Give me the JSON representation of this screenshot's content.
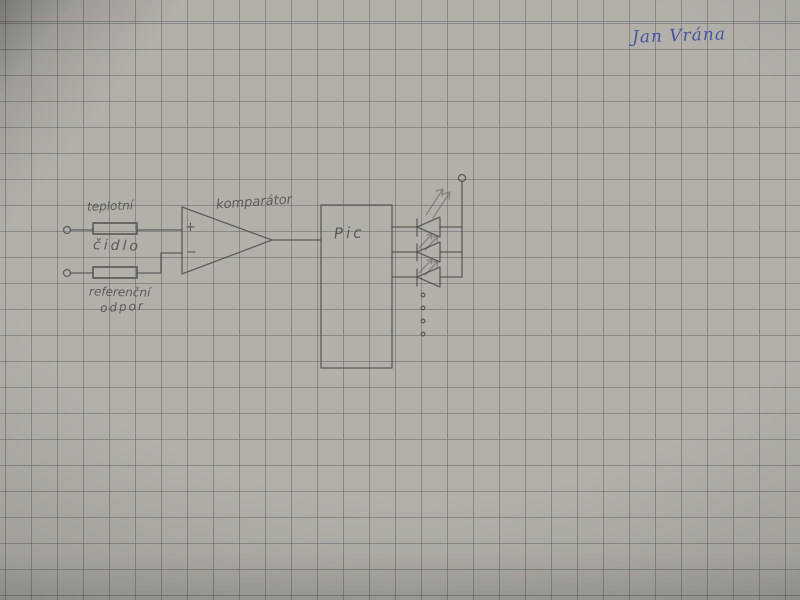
{
  "photo": {
    "description": "photograph of a hand-drawn electronic schematic in pencil on squared graph paper, signed in blue pen",
    "colors": {
      "paper": "#b2b0a9",
      "grid_line": "#84868a",
      "pencil": "#4e4c48",
      "pen_ink": "#4150a4"
    }
  },
  "signature": {
    "text": "Jan Vrána"
  },
  "labels": {
    "sensor_line1": "teplotní",
    "sensor_line2": "čidlo",
    "reference_line1": "referenční",
    "reference_line2": "odpor",
    "comparator": "komparátor",
    "mcu": "Pic",
    "plus_input": "+",
    "minus_input": "−"
  },
  "schematic": {
    "components": [
      {
        "name": "input-terminal-top",
        "symbol": "open circle"
      },
      {
        "name": "temperature-sensor-resistor",
        "symbol": "rectangle",
        "label": "teplotní čidlo"
      },
      {
        "name": "input-terminal-bottom",
        "symbol": "open circle"
      },
      {
        "name": "reference-resistor",
        "symbol": "rectangle",
        "label": "referenční odpor"
      },
      {
        "name": "comparator",
        "symbol": "op-amp triangle",
        "inputs": [
          "+",
          "−"
        ],
        "label": "komparátor"
      },
      {
        "name": "microcontroller",
        "symbol": "rectangle",
        "label": "Pic"
      },
      {
        "name": "led-array",
        "symbol": "LED triangles with emission arrows",
        "led_count": 3
      },
      {
        "name": "continuation-dots",
        "count": 4
      },
      {
        "name": "supply-terminal",
        "symbol": "open circle"
      }
    ]
  }
}
